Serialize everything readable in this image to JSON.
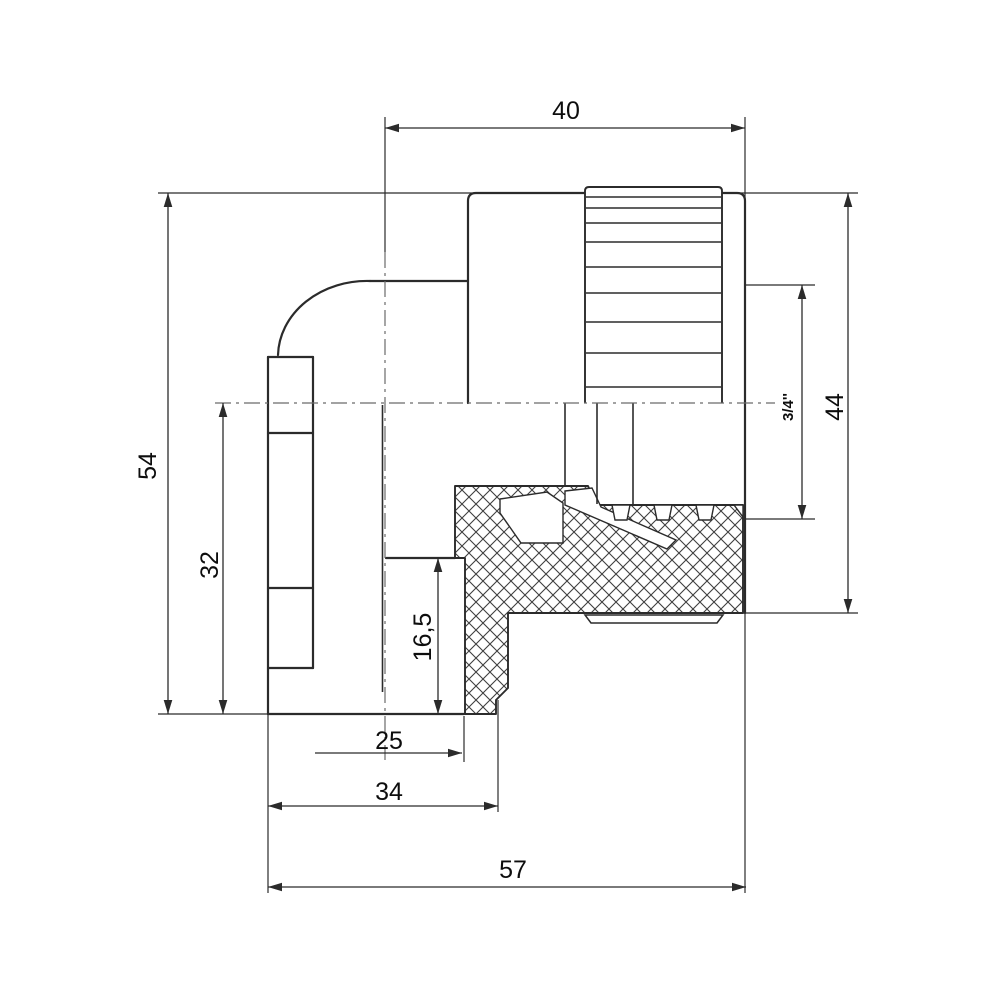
{
  "drawing": {
    "part_description": "90-degree elbow pipe fitting with knurled female threaded insert, half-section technical drawing",
    "background_color": "#ffffff",
    "line_color": "#2b2b2b",
    "hatch_color": "#3f3f3f",
    "dims": {
      "d40": "40",
      "d54": "54",
      "d32": "32",
      "d44": "44",
      "d34_inch": "3/4''",
      "d165": "16,5",
      "d25": "25",
      "d34": "34",
      "d57": "57"
    }
  }
}
